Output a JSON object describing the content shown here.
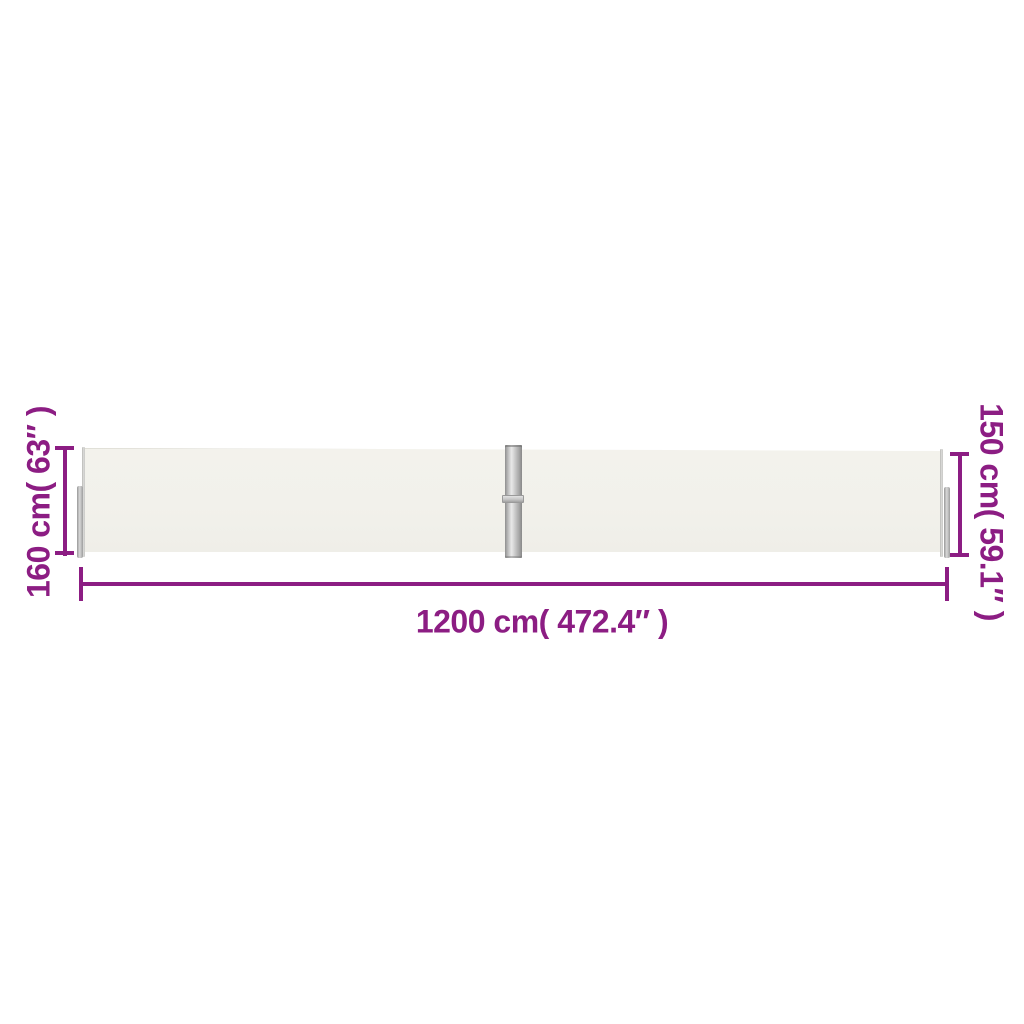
{
  "scene": {
    "background_color": "#ffffff",
    "annotation_color": "#8c1d83",
    "fabric_color": "#f2f1eb",
    "pole_color_light": "#e9e9e9",
    "pole_color_dark": "#8f8f8f"
  },
  "annotations": {
    "left_height": {
      "label": "160 cm( 63″ )"
    },
    "right_height": {
      "label": "150 cm( 59.1″ )"
    },
    "bottom_width": {
      "label": "1200 cm( 472.4″ )"
    }
  }
}
